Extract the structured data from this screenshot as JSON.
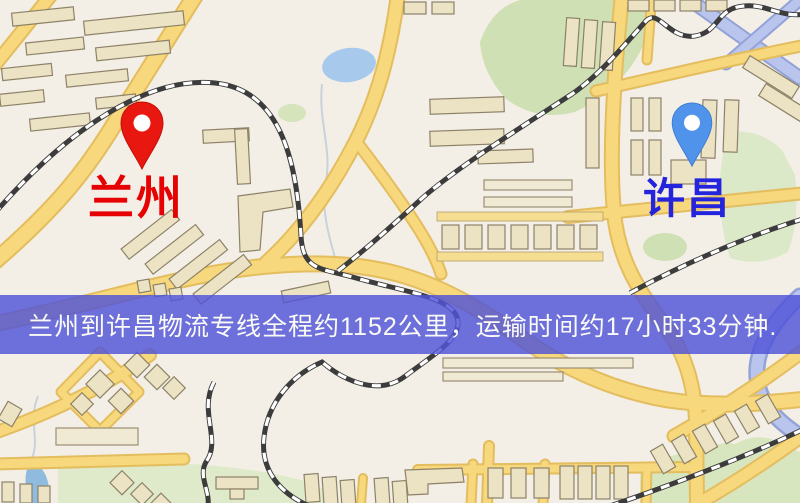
{
  "banner": {
    "text": "兰州到许昌物流专线全程约1152公里，运输时间约17小时33分钟."
  },
  "markers": [
    {
      "id": "lanzhou",
      "label": "兰州",
      "pin_icon": "red-map-pin-icon"
    },
    {
      "id": "xuchang",
      "label": "许昌",
      "pin_icon": "blue-map-pin-icon"
    }
  ],
  "colors": {
    "banner_bg": "rgba(79,83,216,0.82)",
    "banner_text": "#fbfbf5",
    "pin_red": "#e8170f",
    "label_red": "#e60202",
    "pin_blue": "#5093ea",
    "label_blue": "#2424dc",
    "map_bg": "#f3efe7",
    "road_yellow": "#f8d87c",
    "railway_dark": "#3c3c3c",
    "water_blue": "#a6c9ec",
    "park_green": "#d5e4ba",
    "building_fill": "#ece3c5"
  }
}
